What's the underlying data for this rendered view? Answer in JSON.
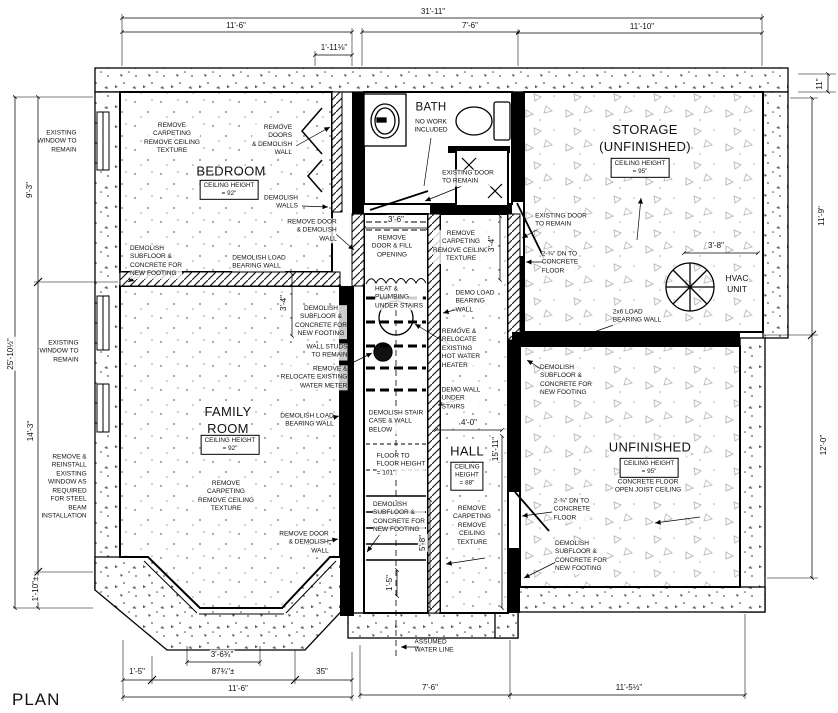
{
  "title": "PLAN",
  "rooms": {
    "bedroom": {
      "name": "BEDROOM",
      "ceiling": "CEILING HEIGHT\n= 92\""
    },
    "bath": {
      "name": "BATH",
      "note": "NO WORK\nINCLUDED"
    },
    "storage": {
      "name": "STORAGE\n(UNFINISHED)",
      "ceiling": "CEILING HEIGHT\n= 95\""
    },
    "family": {
      "name": "FAMILY\nROOM",
      "ceiling": "CEILING HEIGHT\n= 92\""
    },
    "hall": {
      "name": "HALL",
      "ceiling": "CEILING\nHEIGHT\n= 88\""
    },
    "unfinished": {
      "name": "UNFINISHED",
      "ceiling": "CEILING HEIGHT\n= 95\"",
      "note": "CONCRETE FLOOR\nOPEN JOIST CEILING"
    },
    "hvac": {
      "name": "HVAC\nUNIT"
    }
  },
  "annotations": {
    "existing_window_top": "EXISTING\nWINDOW TO\nREMAIN",
    "existing_window_mid": "EXISTING\nWINDOW TO\nREMAIN",
    "remove_reinstall_window": "REMOVE &\nREINSTALL\nEXISTING\nWINDOW AS\nREQUIRED\nFOR STEEL\nBEAM\nINSTALLATION",
    "remove_carpet_bedroom": "REMOVE\nCARPETING\nREMOVE CEILING\nTEXTURE",
    "remove_doors_demolish": "REMOVE\nDOORS\n& DEMOLISH\nWALL",
    "demolish_walls": "DEMOLISH\nWALLS",
    "remove_door_demolish_bedroom": "REMOVE DOOR\n& DEMOLISH\nWALL",
    "existing_door_bath": "EXISTING DOOR\nTO REMAIN",
    "existing_door_storage": "EXISTING DOOR\nTO REMAIN",
    "dn_concrete_storage": "2-¾\" DN TO\nCONCRETE\nFLOOR",
    "load_2x6": "2x6 LOAD\nBEARING WALL",
    "demolish_subfloor_left": "DEMOLISH\nSUBFLOOR &\nCONCRETE FOR\nNEW FOOTING",
    "demolish_load_bearing_top": "DEMOLISH LOAD\nBEARING WALL",
    "remove_door_fill": "REMOVE\nDOOR & FILL\nOPENING",
    "remove_carpet_corridor": "REMOVE\nCARPETING\nREMOVE CEILING\nTEXTURE",
    "heat_plumbing": "HEAT &\nPLUMBING\nUNDER STAIRS",
    "demo_load_bearing": "DEMO LOAD\nBEARING\nWALL",
    "remove_hot_water": "REMOVE &\nRELOCATE\nEXISTING\nHOT WATER\nHEATER",
    "demo_wall_under_stairs": "DEMO WALL\nUNDER\nSTAIRS",
    "demolish_subfloor_center": "DEMOLISH\nSUBFLOOR &\nCONCRETE FOR\nNEW FOOTING",
    "wall_studs": "WALL STUDS\nTO REMAIN",
    "water_meter": "REMOVE &\nRELOCATE EXISTING\nWATER METER",
    "demolish_load_bearing_stair": "DEMOLISH LOAD\nBEARING WALL",
    "demolish_staircase": "DEMOLISH STAIR\nCASE & WALL\nBELOW",
    "floor_to_floor": "FLOOR TO\nFLOOR HEIGHT\n= 101\"",
    "family_remove_carpet": "REMOVE\nCARPETING\nREMOVE CEILING\nTEXTURE",
    "remove_door_family": "REMOVE DOOR\n& DEMOLISH\nWALL",
    "demolish_subfloor_stairs": "DEMOLISH\nSUBFLOOR &\nCONCRETE FOR\nNEW FOOTING",
    "hall_remove_carpet": "REMOVE\nCARPETING\nREMOVE\nCEILING\nTEXTURE",
    "dn_concrete_unfinished": "2-¾\" DN TO\nCONCRETE\nFLOOR",
    "demolish_subfloor_unf_top": "DEMOLISH\nSUBFLOOR &\nCONCRETE FOR\nNEW FOOTING",
    "demolish_subfloor_unf_bottom": "DEMOLISH\nSUBFLOOR &\nCONCRETE FOR\nNEW FOOTING",
    "assumed_water_line": "ASSUMED\nWATER LINE"
  },
  "dimensions": {
    "top": {
      "overall": "31'-11\"",
      "left": "11'-6\"",
      "small": "1'-11⅛\"",
      "mid": "7'-6\"",
      "right": "11'-10\""
    },
    "left": {
      "upper": "9'-3\"",
      "overall": "25'-10½\"",
      "lower": "14'-3\"",
      "bottom": "1'-10\"±"
    },
    "right": {
      "jog": "11\"",
      "upper": "11'-9\"",
      "lower": "12'-0\""
    },
    "bottom": {
      "bay": "3'-6¾\"",
      "b1": "1'-5\"",
      "b2": "87¾\"±",
      "b3": "35\"",
      "left_overall": "11'-6\"",
      "center": "7'-6\"",
      "right": "11'-5½\""
    },
    "interior": {
      "vestibule_w": "3'-6\"",
      "vestibule_h": "3'-4\"",
      "wall_seg": "3'-4\"",
      "hvac": "3'-8\"",
      "hall_w": "4'-0\"",
      "hall_h": "15'-11\"",
      "stair_b": "5'-8\"",
      "stair_s": "1'-5\""
    }
  },
  "colors": {
    "line": "#000000",
    "carpet_dot": "#8a8a8a",
    "concrete_tri": "#bbbbbb"
  }
}
